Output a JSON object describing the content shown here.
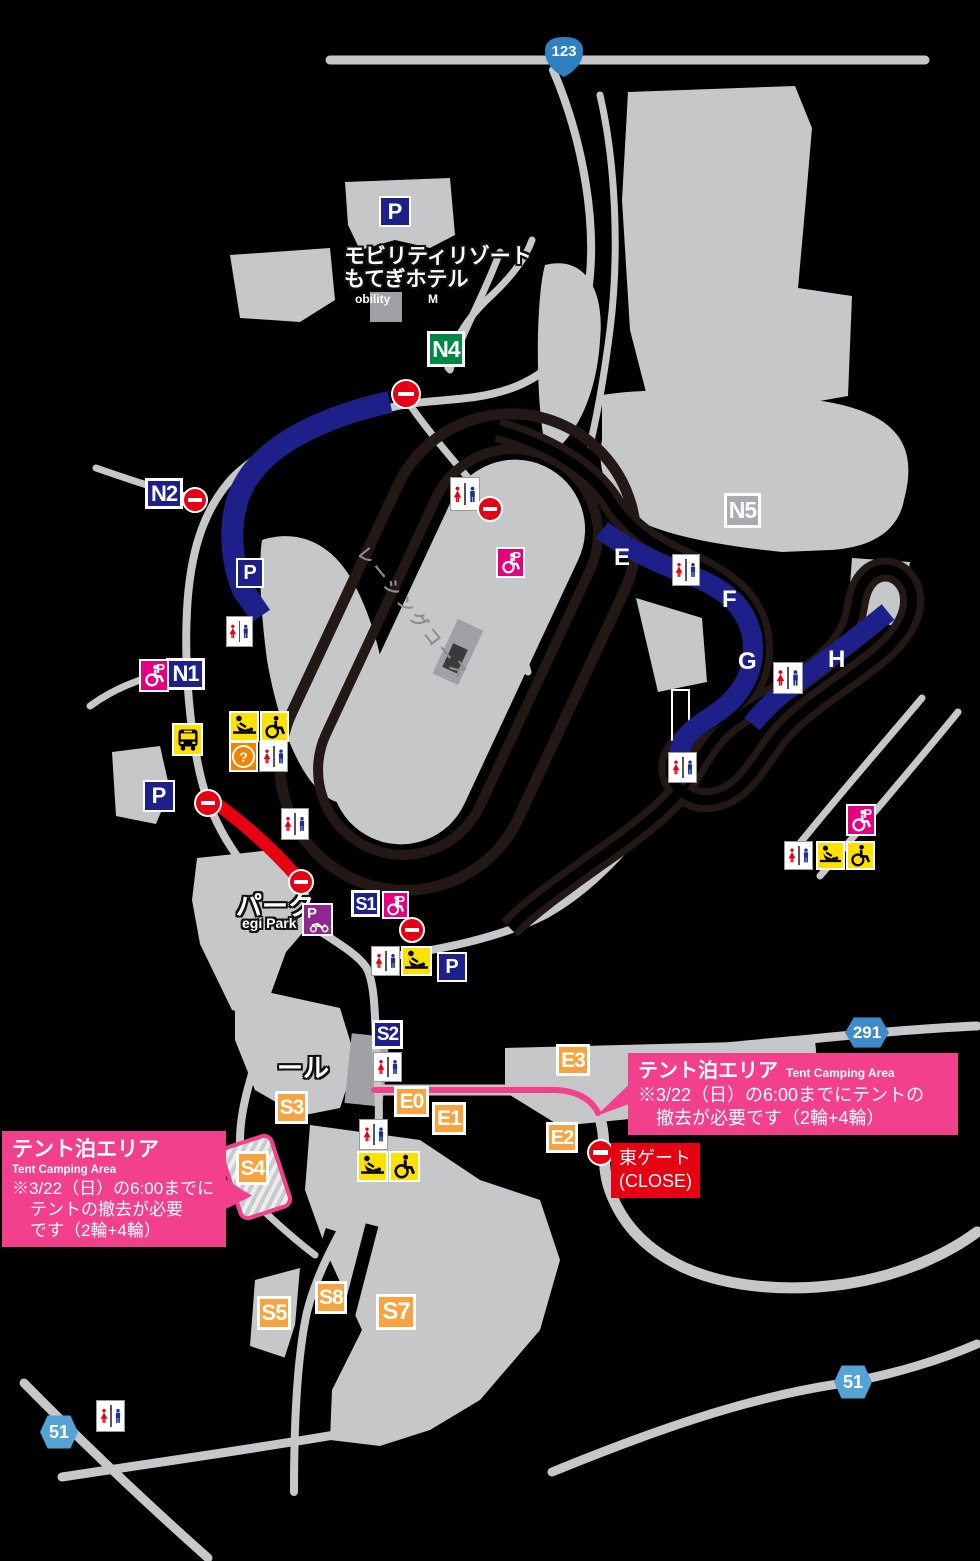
{
  "colors": {
    "background": "#000000",
    "road": "#c6c7c9",
    "building": "#9fa1a5",
    "track_dark": "#231815",
    "band_blue": "#1d2088",
    "band_red": "#e60012",
    "band_pink": "#f2408d",
    "gate_navy": "#1d2088",
    "gate_green": "#008742",
    "gate_orange": "#f7a440",
    "gate_gray": "#a9abb0",
    "badge_blue": "#2e80c0",
    "badge_blue_light": "#55a2d5",
    "icon_yellow": "#ffe100",
    "icon_pink": "#e4007f",
    "icon_purple": "#90278e",
    "icon_orange": "#f08300",
    "toilet_red": "#e60012",
    "toilet_blue": "#1d2f8f",
    "no_entry_red": "#e60012",
    "callout_pink": "#f2408d",
    "east_gate_red": "#e60012"
  },
  "labels": {
    "hotel_line1": "モビリティリゾート",
    "hotel_line2": "もてぎホテル",
    "hotel_en_frag1": "obility",
    "hotel_en_frag2": "M",
    "park": "パーク",
    "park_en": "egi Park",
    "hall_fragment": "ール",
    "racing_course": "レーシングコース",
    "parking_letter": "P",
    "question_mark": "?"
  },
  "gates": [
    {
      "id": "N4"
    },
    {
      "id": "N2"
    },
    {
      "id": "N1"
    },
    {
      "id": "N5"
    },
    {
      "id": "S1"
    },
    {
      "id": "S2"
    },
    {
      "id": "S3"
    },
    {
      "id": "S4"
    },
    {
      "id": "S5"
    },
    {
      "id": "S7"
    },
    {
      "id": "S8"
    },
    {
      "id": "E0"
    },
    {
      "id": "E1"
    },
    {
      "id": "E2"
    },
    {
      "id": "E3"
    }
  ],
  "track_sections": [
    "E",
    "F",
    "G",
    "H"
  ],
  "route_badges": [
    "123",
    "291",
    "51",
    "51"
  ],
  "callout_right": {
    "title": "テント泊エリア",
    "subtitle": "Tent Camping Area",
    "line1": "※3/22（日）の6:00までにテントの",
    "line2": "撤去が必要です（2輪+4輪）"
  },
  "callout_left": {
    "title": "テント泊エリア",
    "subtitle": "Tent Camping Area",
    "line1": "※3/22（日）の6:00までに",
    "line2": "テントの撤去が必要",
    "line3": "です（2輪+4輪）"
  },
  "east_gate": {
    "line1": "東ゲート",
    "line2": "(CLOSE)"
  }
}
